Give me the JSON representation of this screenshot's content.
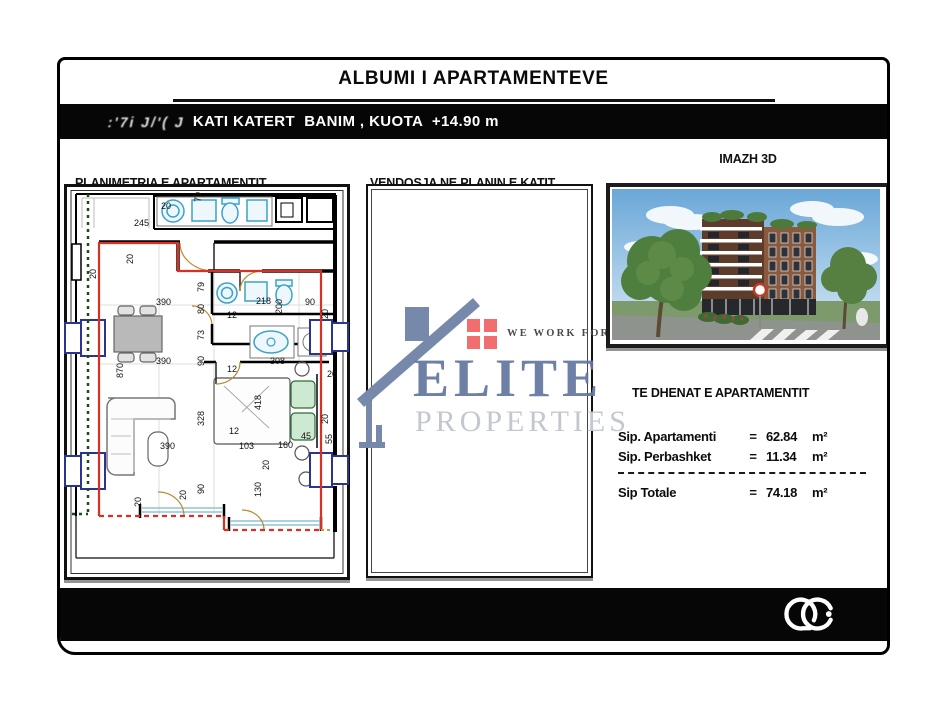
{
  "header": {
    "title": "ALBUMI I APARTAMENTEVE"
  },
  "floor_bar": {
    "scribble": ":'7i J/'( J",
    "label": "KATI KATERT  BANIM , KUOTA  +14.90 m"
  },
  "panels": {
    "plan": {
      "title": "PLANIMETRIA E APARTAMENTIT",
      "scale": "SHK 1:100"
    },
    "site": {
      "title": "VENDOSJA NE PLANIN E KATIT",
      "scale": "SHK 1:500"
    },
    "render": {
      "title": "IMAZH 3D"
    }
  },
  "watermark": {
    "name": "ELITE",
    "name2": "PROPERTIES",
    "tagline": "WE WORK FOR Y",
    "brand_blue": "#64779f",
    "brand_gray": "#c3c7d0",
    "squares_red": "#f26d6d"
  },
  "details": {
    "heading": "TE DHENAT E APARTAMENTIT",
    "rows": [
      {
        "label": "Sip. Apartamenti",
        "eq": "=",
        "value": "62.84",
        "unit": "m²"
      },
      {
        "label": "Sip. Perbashket",
        "eq": "=",
        "value": "11.34",
        "unit": "m²"
      }
    ],
    "total": {
      "label": "Sip Totale",
      "eq": "=",
      "value": "74.18",
      "unit": "m²"
    }
  },
  "plan": {
    "colors": {
      "boundary_red": "#d93025",
      "parcel_green": "#184f18",
      "window_blue": "#2a3590",
      "fixture_cyan": "#39a3c9"
    },
    "dimensions": [
      {
        "t": "20",
        "x": 97,
        "y": 25
      },
      {
        "t": "245",
        "x": 70,
        "y": 42
      },
      {
        "t": "79",
        "x": 137,
        "y": 18,
        "r": 1
      },
      {
        "t": "20",
        "x": 69,
        "y": 80,
        "r": 1
      },
      {
        "t": "20",
        "x": 32,
        "y": 95,
        "r": 1
      },
      {
        "t": "390",
        "x": 92,
        "y": 121
      },
      {
        "t": "79",
        "x": 140,
        "y": 108,
        "r": 1
      },
      {
        "t": "218",
        "x": 192,
        "y": 120
      },
      {
        "t": "200",
        "x": 218,
        "y": 130,
        "r": 1
      },
      {
        "t": "90",
        "x": 241,
        "y": 121
      },
      {
        "t": "80",
        "x": 140,
        "y": 130,
        "r": 1
      },
      {
        "t": "12",
        "x": 163,
        "y": 134
      },
      {
        "t": "73",
        "x": 140,
        "y": 156,
        "r": 1
      },
      {
        "t": "90",
        "x": 140,
        "y": 182,
        "r": 1
      },
      {
        "t": "390",
        "x": 92,
        "y": 180
      },
      {
        "t": "870",
        "x": 59,
        "y": 194,
        "r": 1
      },
      {
        "t": "12",
        "x": 163,
        "y": 188
      },
      {
        "t": "308",
        "x": 206,
        "y": 180
      },
      {
        "t": "328",
        "x": 140,
        "y": 242,
        "r": 1
      },
      {
        "t": "12",
        "x": 165,
        "y": 250
      },
      {
        "t": "103",
        "x": 175,
        "y": 265
      },
      {
        "t": "160",
        "x": 214,
        "y": 264
      },
      {
        "t": "45",
        "x": 237,
        "y": 255
      },
      {
        "t": "418",
        "x": 197,
        "y": 226,
        "r": 1
      },
      {
        "t": "20",
        "x": 205,
        "y": 286,
        "r": 1
      },
      {
        "t": "130",
        "x": 197,
        "y": 313,
        "r": 1
      },
      {
        "t": "90",
        "x": 140,
        "y": 310,
        "r": 1
      },
      {
        "t": "20",
        "x": 122,
        "y": 316,
        "r": 1
      },
      {
        "t": "20",
        "x": 77,
        "y": 323,
        "r": 1
      },
      {
        "t": "390",
        "x": 96,
        "y": 265
      },
      {
        "t": "20",
        "x": 264,
        "y": 135,
        "r": 1
      },
      {
        "t": "20",
        "x": 263,
        "y": 193
      },
      {
        "t": "20",
        "x": 264,
        "y": 240,
        "r": 1
      },
      {
        "t": "55",
        "x": 268,
        "y": 260,
        "r": 1
      }
    ]
  }
}
